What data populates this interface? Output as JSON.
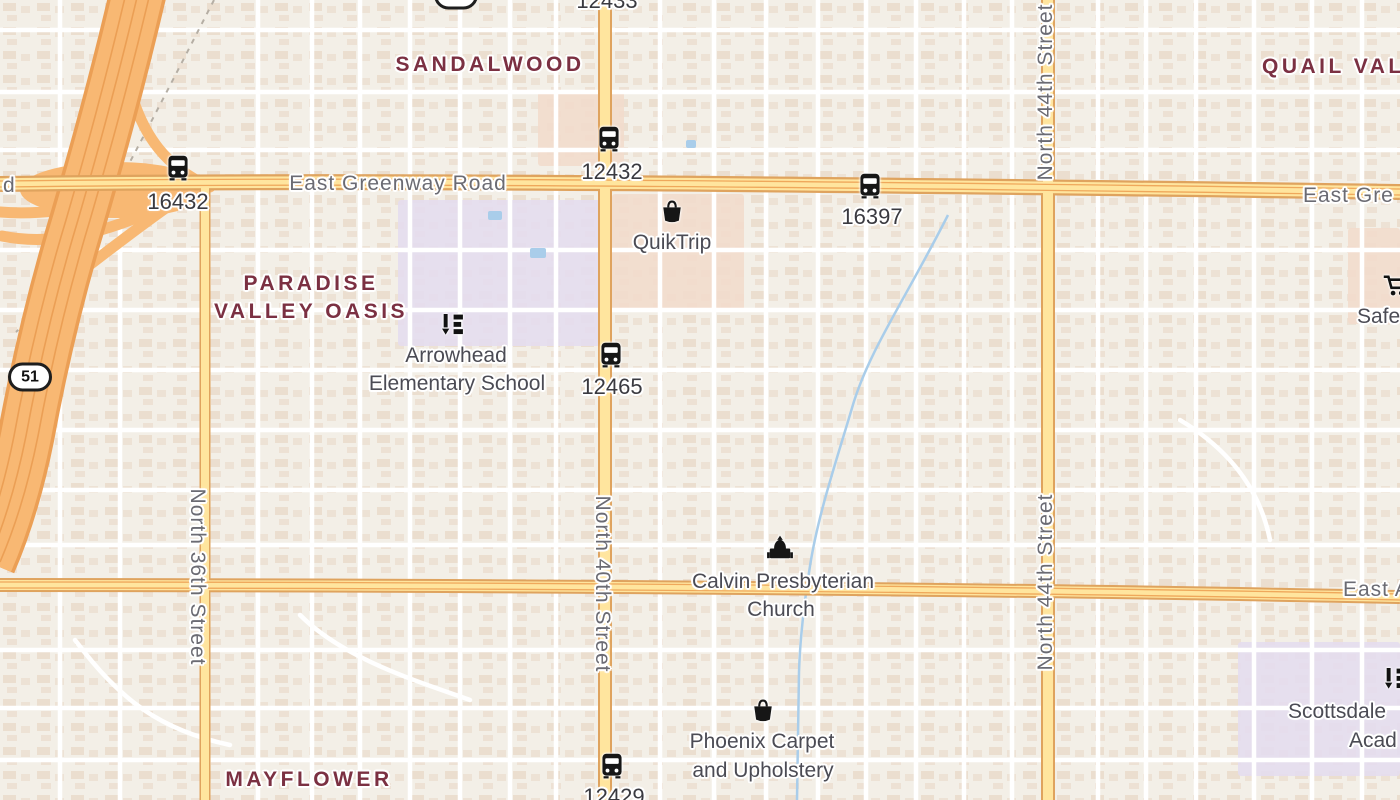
{
  "colors": {
    "background": "#f3efe7",
    "building": "#e9dac9",
    "road_minor": "#ffffff",
    "road_arterial_fill": "#ffe59e",
    "road_arterial_casing": "#dfa35e",
    "freeway_fill": "#f8b873",
    "freeway_casing": "#eb9f55",
    "water": "#a9cdea",
    "education_area": "#e4ddee",
    "commercial_area": "#f2dccc",
    "neighborhood_text": "#7b3042",
    "road_text": "#6b6b73",
    "poi_text": "#4b4b54",
    "transit_text": "#3a3a40"
  },
  "neighborhood_labels": [
    {
      "lines": [
        "SANDALWOOD"
      ],
      "x": 490,
      "y": 65
    },
    {
      "lines": [
        "PARADISE",
        "VALLEY OASIS"
      ],
      "x": 311,
      "y": 298
    },
    {
      "lines": [
        "QUAIL VAL"
      ],
      "x": 1262,
      "y": 67,
      "align": "left"
    },
    {
      "lines": [
        "MAYFLOWER"
      ],
      "x": 309,
      "y": 780
    }
  ],
  "road_labels": [
    {
      "text": "East Greenway Road",
      "x": 398,
      "y": 184,
      "rotate": 0
    },
    {
      "text": "East Gre",
      "x": 1303,
      "y": 196,
      "rotate": 0,
      "align": "left"
    },
    {
      "text": "d",
      "x": 3,
      "y": 186,
      "rotate": 0,
      "align": "left"
    },
    {
      "text": "East A",
      "x": 1343,
      "y": 590,
      "rotate": 0,
      "align": "left"
    },
    {
      "text": "North 36th Street",
      "x": 197,
      "y": 577,
      "rotate": 90
    },
    {
      "text": "North 40th Street",
      "x": 602,
      "y": 584,
      "rotate": 90
    },
    {
      "text": "North 44th Street",
      "x": 1046,
      "y": 92,
      "rotate": -90
    },
    {
      "text": "North 44th Street",
      "x": 1046,
      "y": 582,
      "rotate": -90
    }
  ],
  "route_shields": [
    {
      "text": "51",
      "x": 456,
      "y": -5
    },
    {
      "text": "51",
      "x": 30,
      "y": 377
    }
  ],
  "poi_labels": [
    {
      "icon": "shopping-bag",
      "name": "quiktrip",
      "icon_x": 672,
      "icon_y": 214,
      "lines": [
        {
          "text": "QuikTrip",
          "x": 672,
          "y": 243
        }
      ]
    },
    {
      "icon": "school",
      "name": "arrowhead-elementary-school",
      "icon_x": 453,
      "icon_y": 327,
      "lines": [
        {
          "text": "Arrowhead",
          "x": 456,
          "y": 356
        },
        {
          "text": "Elementary School",
          "x": 457,
          "y": 384
        }
      ]
    },
    {
      "icon": "church",
      "name": "calvin-presbyterian-church",
      "icon_x": 780,
      "icon_y": 551,
      "lines": [
        {
          "text": "Calvin Presbyterian",
          "x": 783,
          "y": 582
        },
        {
          "text": "Church",
          "x": 781,
          "y": 610
        }
      ]
    },
    {
      "icon": "shopping-bag",
      "name": "phoenix-carpet-and-upholstery",
      "icon_x": 763,
      "icon_y": 713,
      "lines": [
        {
          "text": "Phoenix Carpet",
          "x": 762,
          "y": 742
        },
        {
          "text": "and Upholstery",
          "x": 763,
          "y": 771
        }
      ]
    },
    {
      "icon": "shopping-cart",
      "name": "safeway",
      "icon_x": 1396,
      "icon_y": 288,
      "lines": [
        {
          "text": "Safe",
          "x": 1357,
          "y": 317,
          "align": "left"
        }
      ]
    },
    {
      "icon": "school",
      "name": "scottsdale-academy",
      "icon_x": 1396,
      "icon_y": 681,
      "lines": [
        {
          "text": "Scottsdale",
          "x": 1288,
          "y": 712,
          "align": "left"
        },
        {
          "text": "Acad",
          "x": 1349,
          "y": 741,
          "align": "left"
        }
      ]
    }
  ],
  "bus_stops": [
    {
      "id": "16432",
      "icon_x": 178,
      "icon_y": 170,
      "label_x": 178,
      "label_y": 202
    },
    {
      "id": "12432",
      "icon_x": 609,
      "icon_y": 141,
      "label_x": 612,
      "label_y": 172
    },
    {
      "id": "16397",
      "icon_x": 870,
      "icon_y": 188,
      "label_x": 872,
      "label_y": 217
    },
    {
      "id": "12465",
      "icon_x": 611,
      "icon_y": 357,
      "label_x": 612,
      "label_y": 387
    },
    {
      "id": "12429",
      "icon_x": 612,
      "icon_y": 768,
      "label_x": 614,
      "label_y": 797
    },
    {
      "id": "12433",
      "label_x": 607,
      "label_y": 1
    }
  ]
}
